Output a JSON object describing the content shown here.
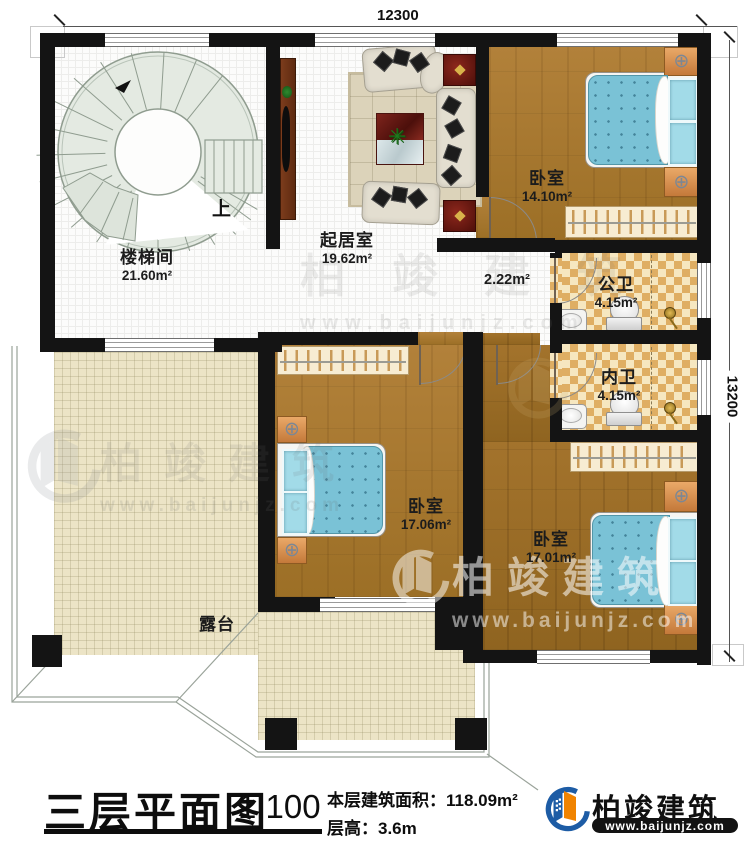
{
  "plan": {
    "dimensions": {
      "top": "12300",
      "right": "13200"
    },
    "rooms": [
      {
        "name": "楼梯间",
        "area": "21.60m²"
      },
      {
        "name": "起居室",
        "area": "19.62m²"
      },
      {
        "name": "卧室",
        "area": "14.10m²"
      },
      {
        "name": "公卫",
        "area": "4.15m²"
      },
      {
        "name": "内卫",
        "area": "4.15m²"
      },
      {
        "name": "卧室",
        "area": "17.06m²"
      },
      {
        "name": "卧室",
        "area": "17.01m²"
      },
      {
        "name": "露台",
        "area": ""
      }
    ],
    "labels": {
      "up": "上",
      "small_area": "2.22m²"
    }
  },
  "footer": {
    "title": "三层平面图",
    "scale": "1:100",
    "area_label": "本层建筑面积：",
    "area_value": "118.09m²",
    "height_label": "层高：",
    "height_value": "3.6m"
  },
  "brand": {
    "name": "柏竣建筑",
    "url": "www.baijunjz.com"
  },
  "watermark": {
    "name": "柏竣建筑",
    "url": "www.baijunjz.com"
  },
  "colors": {
    "wall": "#141414",
    "wood": "#a8762c",
    "bed": "#7ac2d6",
    "checker_dark": "#dfae63",
    "checker_light": "#f6e7c0",
    "terrace": "#ece4c6",
    "brand_blue": "#1d5ca5",
    "brand_orange": "#f08300"
  }
}
